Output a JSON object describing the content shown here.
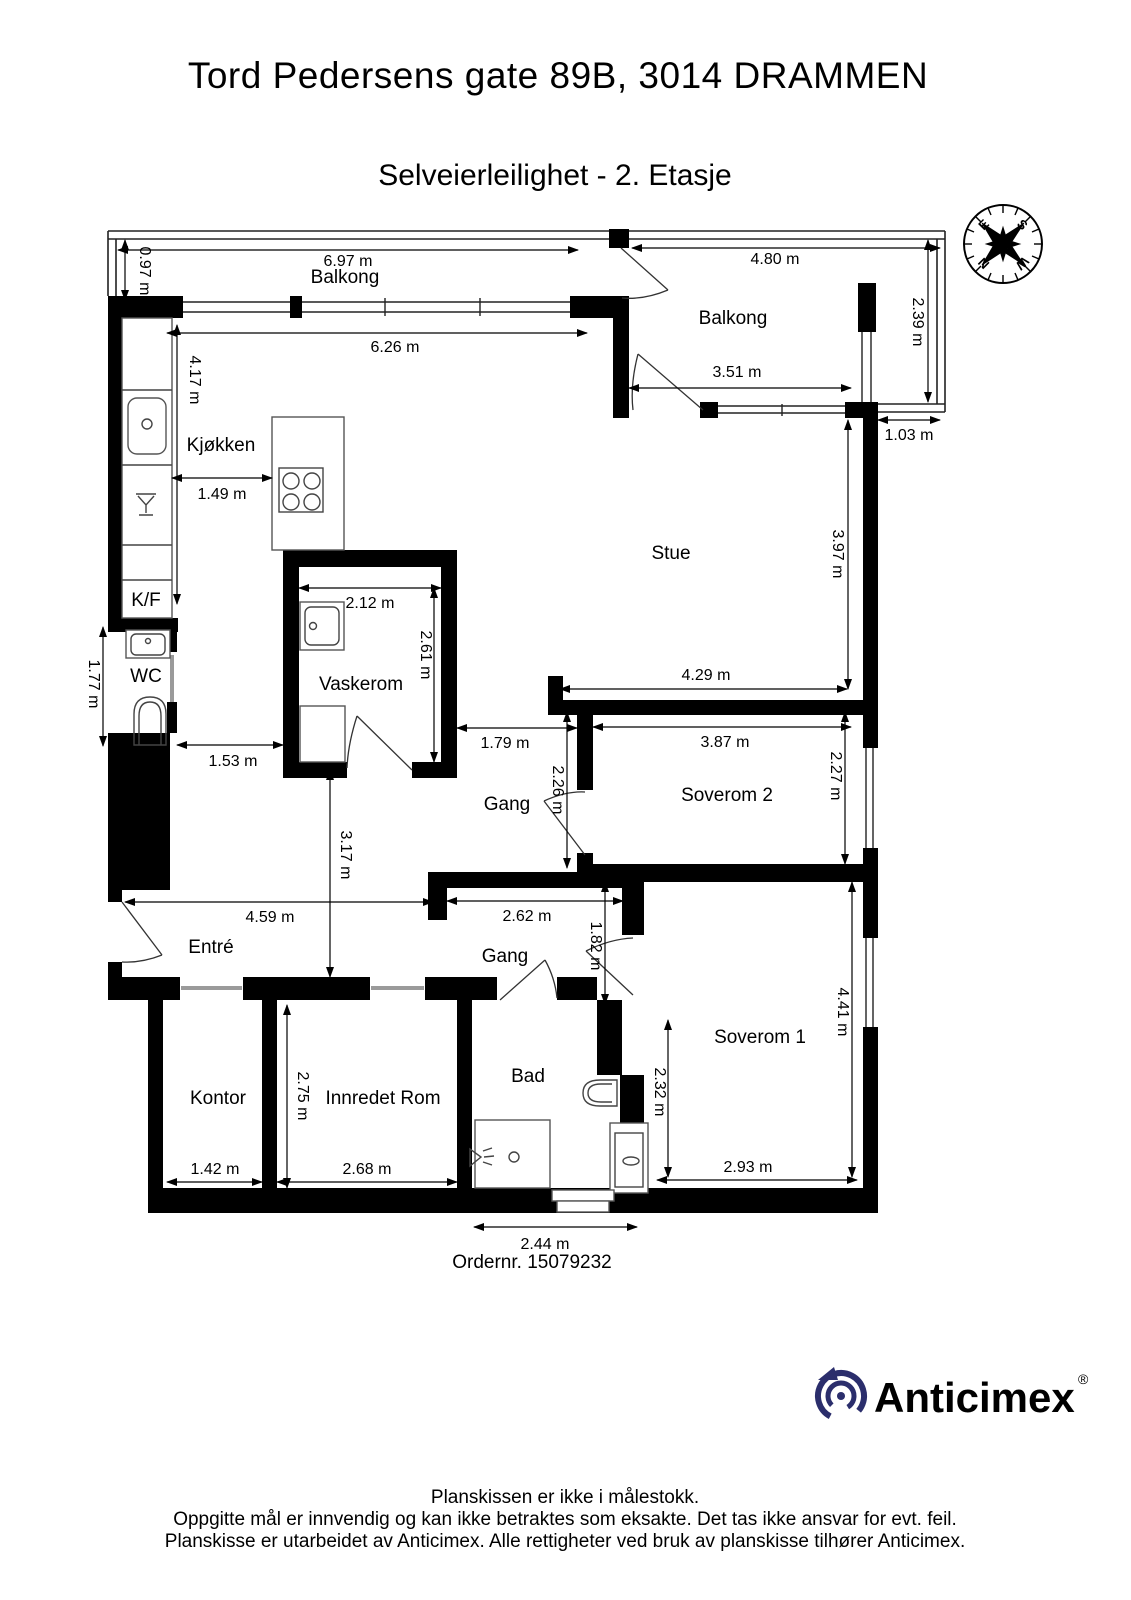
{
  "header": {
    "title": "Tord Pedersens gate 89B, 3014 DRAMMEN",
    "subtitle": "Selveierleilighet  - 2. Etasje"
  },
  "plan": {
    "rooms": {
      "balkong_left": "Balkong",
      "balkong_right": "Balkong",
      "kjokken": "Kjøkken",
      "kf": "K/F",
      "wc": "WC",
      "vaskerom": "Vaskerom",
      "stue": "Stue",
      "gang1": "Gang",
      "soverom2": "Soverom 2",
      "entre": "Entré",
      "gang2": "Gang",
      "kontor": "Kontor",
      "innredet_rom": "Innredet Rom",
      "bad": "Bad",
      "soverom1": "Soverom 1"
    },
    "dims": {
      "balkong_left_width": "6.97 m",
      "balkong_left_depth": "0.97 m",
      "balkong_right_width": "4.80 m",
      "balkong_right_depth": "2.39 m",
      "balkong_right_inner": "3.51 m",
      "balkong_right_side": "1.03 m",
      "kjokken_width": "6.26 m",
      "kjokken_height": "4.17 m",
      "island_gap": "1.49 m",
      "vaskerom_width": "2.12 m",
      "vaskerom_height": "2.61 m",
      "stue_height": "3.97 m",
      "stue_width": "4.29 m",
      "wc_height": "1.77 m",
      "wc_gap": "1.53 m",
      "gang1_width": "1.79 m",
      "gang1_height": "2.26 m",
      "soverom2_width": "3.87 m",
      "soverom2_height": "2.27 m",
      "mid_height": "3.17 m",
      "entre_width": "4.59 m",
      "gang2_width": "2.62 m",
      "gang2_height": "1.82 m",
      "kontor_width": "1.42 m",
      "innredet_height": "2.75 m",
      "innredet_width": "2.68 m",
      "soverom1_inner_height": "2.32 m",
      "soverom1_height": "4.41 m",
      "soverom1_width": "2.93 m",
      "bad_width": "2.44 m"
    },
    "order_number": "Ordernr. 15079232"
  },
  "compass": {
    "n": "N",
    "e": "E",
    "s": "S",
    "w": "W"
  },
  "logo": {
    "brand": "Anticimex",
    "registered": "®"
  },
  "footer": {
    "line1": "Planskissen er ikke i målestokk.",
    "line2": "Oppgitte mål er innvendig og kan ikke betraktes som eksakte. Det tas ikke ansvar for evt. feil.",
    "line3": "Planskisse er utarbeidet av Anticimex. Alle rettigheter ved bruk av planskisse tilhører Anticimex."
  },
  "colors": {
    "wall": "#000000",
    "logo_navy": "#2b2e6c"
  }
}
